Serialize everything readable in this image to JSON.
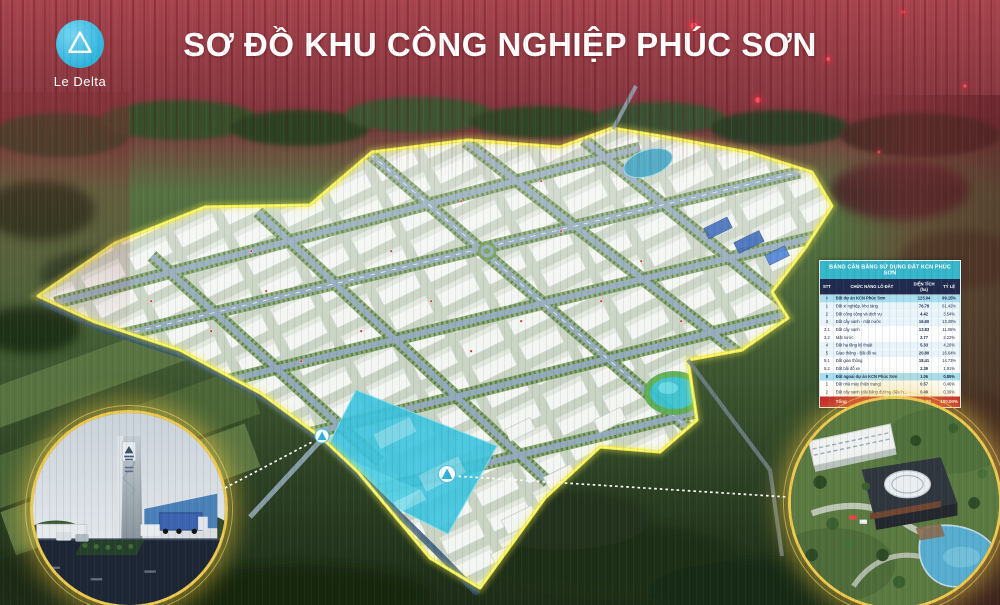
{
  "poster": {
    "title": "SƠ ĐỒ KHU CÔNG NGHIỆP PHÚC SƠN",
    "logo_text": "Le Delta"
  },
  "land_use_table": {
    "title": "BẢNG CÂN BẰNG SỬ DỤNG ĐẤT KCN PHÚC SƠN",
    "columns": [
      "STT",
      "CHỨC NĂNG LÔ ĐẤT",
      "DIỆN TÍCH (ha)",
      "TỶ LỆ"
    ],
    "rows": [
      {
        "stt": "I",
        "label": "Đất dự án KCN Phúc Sơn",
        "area": "123.94",
        "ratio": "99.15%",
        "kind": "section"
      },
      {
        "stt": "1",
        "label": "Đất xí nghiệp, kho tàng",
        "area": "76.78",
        "ratio": "61.42%",
        "kind": "normal"
      },
      {
        "stt": "2",
        "label": "Đất công cộng và dịch vụ",
        "area": "4.42",
        "ratio": "3.54%",
        "kind": "normal"
      },
      {
        "stt": "3",
        "label": "Đất cây xanh - mặt nước",
        "area": "16.60",
        "ratio": "13.28%",
        "kind": "normal"
      },
      {
        "stt": "3.1",
        "label": "Đất cây xanh",
        "area": "13.83",
        "ratio": "11.06%",
        "kind": "sub"
      },
      {
        "stt": "3.2",
        "label": "Mặt nước",
        "area": "2.77",
        "ratio": "2.22%",
        "kind": "sub"
      },
      {
        "stt": "4",
        "label": "Đất hạ tầng kỹ thuật",
        "area": "5.33",
        "ratio": "4.26%",
        "kind": "normal"
      },
      {
        "stt": "5",
        "label": "Giao thông - Bãi đỗ xe",
        "area": "20.80",
        "ratio": "16.64%",
        "kind": "normal"
      },
      {
        "stt": "5.1",
        "label": "Đất giao thông",
        "area": "18.41",
        "ratio": "14.73%",
        "kind": "sub"
      },
      {
        "stt": "5.2",
        "label": "Đất bãi đỗ xe",
        "area": "2.39",
        "ratio": "1.91%",
        "kind": "sub"
      },
      {
        "stt": "II",
        "label": "Đất ngoài dự án KCN Phúc Sơn",
        "area": "1.06",
        "ratio": "0.85%",
        "kind": "section"
      },
      {
        "stt": "1",
        "label": "Đất nhà máy (hiện trạng)",
        "area": "0.57",
        "ratio": "0.46%",
        "kind": "sub"
      },
      {
        "stt": "2",
        "label": "Đất cây xanh (dải băng đường điện hiện trạng)",
        "area": "0.49",
        "ratio": "0.39%",
        "kind": "sub"
      }
    ],
    "total": {
      "stt": "",
      "label": "Tổng",
      "area": "125.00",
      "ratio": "100.00%"
    }
  },
  "insets": {
    "left": "entrance-gate-monument-render",
    "right": "administration-building-render"
  },
  "colors": {
    "banner_red": "#8d3a42",
    "boundary_yellow": "#f2ec3a",
    "lake_cyan": "#3ac4de",
    "table_header_teal": "#35b6cb",
    "table_header_navy": "#202b4f",
    "table_total_red": "#c1202c",
    "logo_cyan": "#2fb3dc",
    "gold_ring": "#edc94f"
  }
}
